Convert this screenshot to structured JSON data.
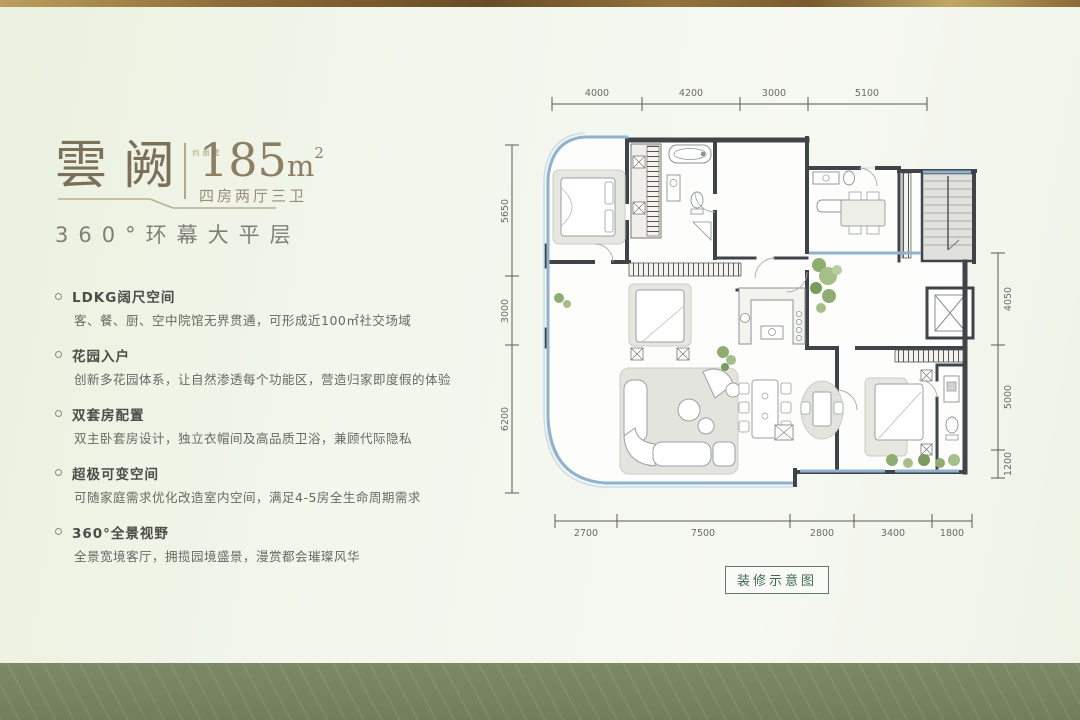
{
  "title": {
    "name": "雲阙",
    "area_prefix": "建面约",
    "area_value": "185",
    "area_unit": "m",
    "area_sup": "2",
    "layout": "四房两厅三卫",
    "subtitle": "360°环幕大平层"
  },
  "features": [
    {
      "title": "LDKG阔尺空间",
      "desc": "客、餐、厨、空中院馆无界贯通，可形成近100㎡社交场域"
    },
    {
      "title": "花园入户",
      "desc": "创新多花园体系，让自然渗透每个功能区，营造归家即度假的体验"
    },
    {
      "title": "双套房配置",
      "desc": "双主卧套房设计，独立衣帽间及高品质卫浴，兼顾代际隐私"
    },
    {
      "title": "超极可变空间",
      "desc": "可随家庭需求优化改造室内空间，满足4-5房全生命周期需求"
    },
    {
      "title": "360°全景视野",
      "desc": "全景宽境客厅，拥揽园境盛景，漫赏都会璀璨风华"
    }
  ],
  "floorplan": {
    "caption": "装修示意图",
    "dims": {
      "top": [
        "4000",
        "4200",
        "3000",
        "5100"
      ],
      "left": [
        "5650",
        "3000",
        "6200"
      ],
      "right": [
        "4050",
        "5000",
        "1200"
      ],
      "bottom": [
        "2700",
        "7500",
        "2800",
        "3400",
        "1800"
      ]
    }
  },
  "colors": {
    "gold_accent": "#8a6a35",
    "sage_band": "#7f8b68",
    "wall": "#3f444a",
    "glass_blue": "#8fb2cf",
    "plant_green": "#8fac72",
    "caption_green": "#3e6b4f",
    "title_brown": "#7b705a"
  }
}
